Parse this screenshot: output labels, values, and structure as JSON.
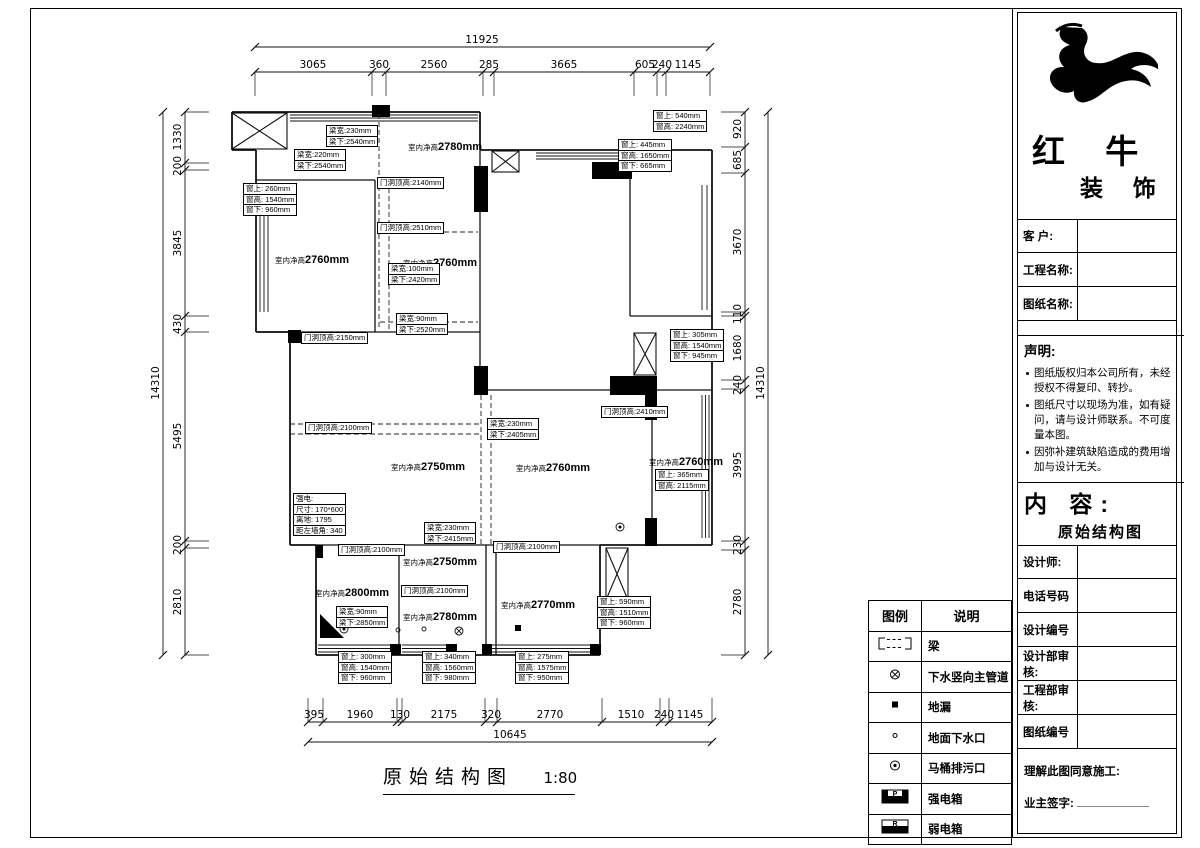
{
  "title": {
    "text": "原始结构图",
    "scale": "1:80"
  },
  "sheet": {
    "brand": {
      "name1": "红 牛",
      "name2": "装 饰"
    },
    "fields": [
      "客  户:",
      "工程名称:",
      "图纸名称:"
    ],
    "statement": {
      "title": "声明:",
      "items": [
        "图纸版权归本公司所有，未经授权不得复印、转抄。",
        "图纸尺寸以现场为准，如有疑问，请与设计师联系。不可度量本图。",
        "因弥补建筑缺陷造成的费用增加与设计无关。"
      ]
    },
    "content": {
      "label": "内 容:",
      "value": "原始结构图"
    },
    "info_rows": [
      "设计师:",
      "电话号码",
      "设计编号",
      "设计部审核:",
      "工程部审核:",
      "图纸编号"
    ],
    "approve": {
      "line1": "理解此图同意施工:",
      "line2": "业主签字:"
    }
  },
  "legend": {
    "headers": [
      "图例",
      "说明"
    ],
    "rows": [
      {
        "sym": "beam",
        "letter": "",
        "label": "梁"
      },
      {
        "sym": "main-pipe",
        "letter": "",
        "label": "下水竖向主管道"
      },
      {
        "sym": "floor-drain",
        "letter": "",
        "label": "地漏"
      },
      {
        "sym": "ground-outlet",
        "letter": "",
        "label": "地面下水口"
      },
      {
        "sym": "toilet-outlet",
        "letter": "",
        "label": "马桶排污口"
      },
      {
        "sym": "power-box",
        "letter": "P",
        "label": "强电箱"
      },
      {
        "sym": "weak-box",
        "letter": "R",
        "label": "弱电箱"
      }
    ]
  },
  "plan": {
    "room_prefix": "室内净高",
    "rooms": [
      {
        "x": 445,
        "y": 146,
        "v": "2780mm"
      },
      {
        "x": 312,
        "y": 259,
        "v": "2760mm"
      },
      {
        "x": 440,
        "y": 262,
        "v": "2760mm"
      },
      {
        "x": 428,
        "y": 466,
        "v": "2750mm"
      },
      {
        "x": 553,
        "y": 467,
        "v": "2760mm"
      },
      {
        "x": 686,
        "y": 461,
        "v": "2760mm"
      },
      {
        "x": 352,
        "y": 592,
        "v": "2800mm"
      },
      {
        "x": 440,
        "y": 561,
        "v": "2750mm"
      },
      {
        "x": 440,
        "y": 616,
        "v": "2780mm"
      },
      {
        "x": 538,
        "y": 604,
        "v": "2770mm"
      }
    ],
    "notes": [
      {
        "x": 326,
        "y": 126,
        "rows": [
          "梁宽:230mm",
          "梁下:2540mm"
        ]
      },
      {
        "x": 294,
        "y": 150,
        "rows": [
          "梁宽:220mm",
          "梁下:2540mm"
        ]
      },
      {
        "x": 243,
        "y": 184,
        "rows": [
          "窗上: 260mm",
          "窗高: 1540mm",
          "窗下: 960mm"
        ]
      },
      {
        "x": 377,
        "y": 178,
        "rows": [
          "门洞顶高:2140mm"
        ]
      },
      {
        "x": 377,
        "y": 223,
        "rows": [
          "门洞顶高:2510mm"
        ]
      },
      {
        "x": 388,
        "y": 264,
        "rows": [
          "梁宽:100mm",
          "梁下:2420mm"
        ]
      },
      {
        "x": 396,
        "y": 314,
        "rows": [
          "梁宽:90mm",
          "梁下:2520mm"
        ]
      },
      {
        "x": 653,
        "y": 111,
        "rows": [
          "窗上: 540mm",
          "窗高: 2240mm"
        ]
      },
      {
        "x": 618,
        "y": 140,
        "rows": [
          "窗上: 445mm",
          "窗高: 1650mm",
          "窗下: 665mm"
        ]
      },
      {
        "x": 670,
        "y": 330,
        "rows": [
          "窗上: 305mm",
          "窗高: 1540mm",
          "窗下: 945mm"
        ]
      },
      {
        "x": 601,
        "y": 407,
        "rows": [
          "门洞顶高:2410mm"
        ]
      },
      {
        "x": 487,
        "y": 419,
        "rows": [
          "梁宽:230mm",
          "梁下:2405mm"
        ]
      },
      {
        "x": 655,
        "y": 470,
        "rows": [
          "窗上: 365mm",
          "窗高: 2115mm"
        ]
      },
      {
        "x": 301,
        "y": 333,
        "rows": [
          "门洞顶高:2150mm"
        ]
      },
      {
        "x": 305,
        "y": 423,
        "rows": [
          "门洞顶高:2100mm"
        ]
      },
      {
        "x": 293,
        "y": 494,
        "rows": [
          "强电:",
          "尺寸: 170*600",
          "离地: 1795",
          "距左墙角: 340"
        ]
      },
      {
        "x": 338,
        "y": 545,
        "rows": [
          "门洞顶高:2100mm"
        ]
      },
      {
        "x": 401,
        "y": 586,
        "rows": [
          "门洞顶高:2100mm"
        ]
      },
      {
        "x": 493,
        "y": 542,
        "rows": [
          "门洞顶高:2100mm"
        ]
      },
      {
        "x": 336,
        "y": 607,
        "rows": [
          "梁宽:90mm",
          "梁下:2850mm"
        ]
      },
      {
        "x": 424,
        "y": 523,
        "rows": [
          "梁宽:230mm",
          "梁下:2415mm"
        ]
      },
      {
        "x": 338,
        "y": 652,
        "rows": [
          "窗上: 300mm",
          "窗高: 1540mm",
          "窗下: 960mm"
        ]
      },
      {
        "x": 422,
        "y": 652,
        "rows": [
          "窗上: 340mm",
          "窗高: 1560mm",
          "窗下: 980mm"
        ]
      },
      {
        "x": 515,
        "y": 652,
        "rows": [
          "窗上: 275mm",
          "窗高: 1575mm",
          "窗下: 950mm"
        ]
      },
      {
        "x": 597,
        "y": 597,
        "rows": [
          "窗上: 590mm",
          "窗高: 1510mm",
          "窗下: 960mm"
        ]
      }
    ],
    "dims": [
      {
        "o": "h",
        "pos": 47,
        "a": 255,
        "b": 710,
        "ext": 0,
        "ticks": [
          255,
          710
        ],
        "labels": [
          {
            "t": "11925",
            "c": 482
          }
        ]
      },
      {
        "o": "h",
        "pos": 72,
        "a": 255,
        "b": 710,
        "ext": 24,
        "ticks": [
          255,
          372,
          386,
          483,
          494,
          634,
          657,
          666,
          710
        ],
        "labels": [
          {
            "t": "3065",
            "c": 313
          },
          {
            "t": "360",
            "c": 379
          },
          {
            "t": "2560",
            "c": 434
          },
          {
            "t": "285",
            "c": 489
          },
          {
            "t": "3665",
            "c": 564
          },
          {
            "t": "605",
            "c": 645
          },
          {
            "t": "240",
            "c": 662
          },
          {
            "t": "1145",
            "c": 688
          }
        ]
      },
      {
        "o": "h",
        "pos": 722,
        "a": 308,
        "b": 712,
        "ext": -24,
        "ticks": [
          308,
          323,
          397,
          402,
          485,
          497,
          602,
          660,
          669,
          712
        ],
        "labels": [
          {
            "t": "395",
            "c": 314
          },
          {
            "t": "1960",
            "c": 360
          },
          {
            "t": "130",
            "c": 400
          },
          {
            "t": "2175",
            "c": 444
          },
          {
            "t": "320",
            "c": 491
          },
          {
            "t": "2770",
            "c": 550
          },
          {
            "t": "1510",
            "c": 631
          },
          {
            "t": "240",
            "c": 664
          },
          {
            "t": "1145",
            "c": 690
          }
        ]
      },
      {
        "o": "h",
        "pos": 742,
        "a": 308,
        "b": 712,
        "ext": 0,
        "ticks": [
          308,
          712
        ],
        "labels": [
          {
            "t": "10645",
            "c": 510
          }
        ]
      },
      {
        "o": "v",
        "pos": 163,
        "a": 112,
        "b": 655,
        "ext": 0,
        "ticks": [
          112,
          655
        ],
        "labels": [
          {
            "t": "14310",
            "c": 383
          }
        ]
      },
      {
        "o": "v",
        "pos": 185,
        "a": 112,
        "b": 655,
        "ext": 24,
        "ticks": [
          112,
          163,
          170,
          316,
          332,
          541,
          548,
          655
        ],
        "labels": [
          {
            "t": "1330",
            "c": 137
          },
          {
            "t": "200",
            "c": 166
          },
          {
            "t": "3845",
            "c": 243
          },
          {
            "t": "430",
            "c": 324
          },
          {
            "t": "5495",
            "c": 436
          },
          {
            "t": "200",
            "c": 545
          },
          {
            "t": "2810",
            "c": 602
          }
        ]
      },
      {
        "o": "v",
        "pos": 745,
        "a": 112,
        "b": 655,
        "ext": -24,
        "ticks": [
          112,
          147,
          173,
          312,
          316,
          380,
          389,
          541,
          550,
          655
        ],
        "labels": [
          {
            "t": "920",
            "c": 129
          },
          {
            "t": "685",
            "c": 160
          },
          {
            "t": "3670",
            "c": 242
          },
          {
            "t": "110",
            "c": 314
          },
          {
            "t": "1680",
            "c": 348
          },
          {
            "t": "240",
            "c": 385
          },
          {
            "t": "3995",
            "c": 465
          },
          {
            "t": "230",
            "c": 545
          },
          {
            "t": "2780",
            "c": 602
          }
        ]
      },
      {
        "o": "v",
        "pos": 768,
        "a": 112,
        "b": 655,
        "ext": 0,
        "ticks": [
          112,
          655
        ],
        "labels": [
          {
            "t": "14310",
            "c": 383
          }
        ]
      }
    ]
  }
}
